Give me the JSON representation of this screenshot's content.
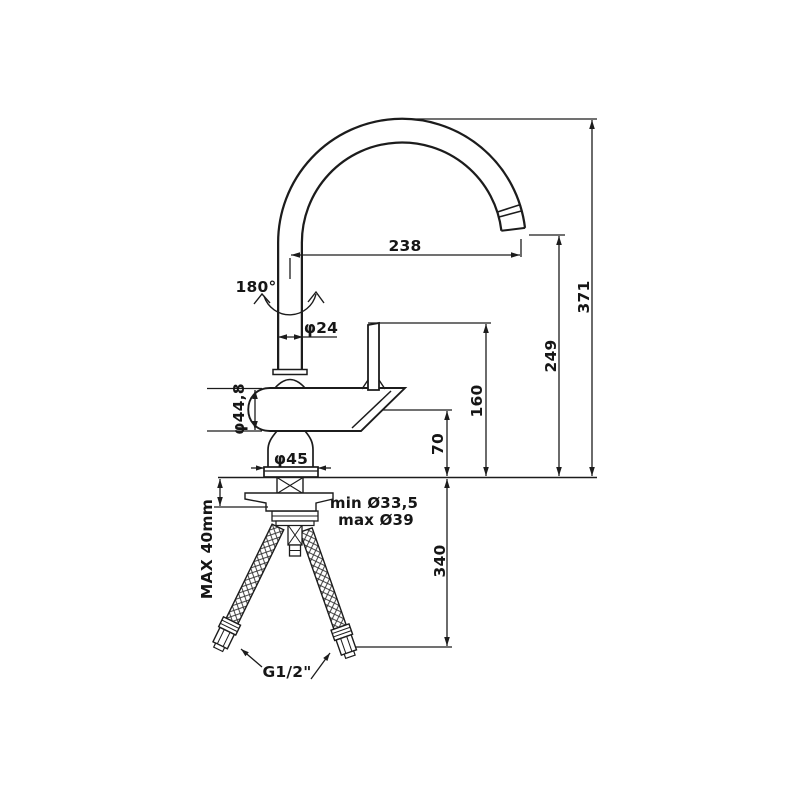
{
  "drawing": {
    "type": "technical dimension drawing",
    "subject": "single-lever kitchen mixer tap with high swivel spout and flexible supply hoses",
    "units": "mm",
    "colors": {
      "line": "#1c1c1c",
      "background": "#ffffff",
      "text": "#161616"
    }
  },
  "labels": {
    "spout_reach": "238",
    "overall_height": "371",
    "outlet_height": "249",
    "lever_top_height": "160",
    "body_top_height": "70",
    "hose_length": "340",
    "rotation_angle": "180°",
    "spout_tube_diameter": "φ24",
    "body_diameter": "φ44,8",
    "base_diameter": "φ45",
    "mounting_hole_min": "min Ø33,5",
    "mounting_hole_max": "max Ø39",
    "counter_max_thickness": "MAX 40mm",
    "connection_thread": "G1/2\""
  }
}
